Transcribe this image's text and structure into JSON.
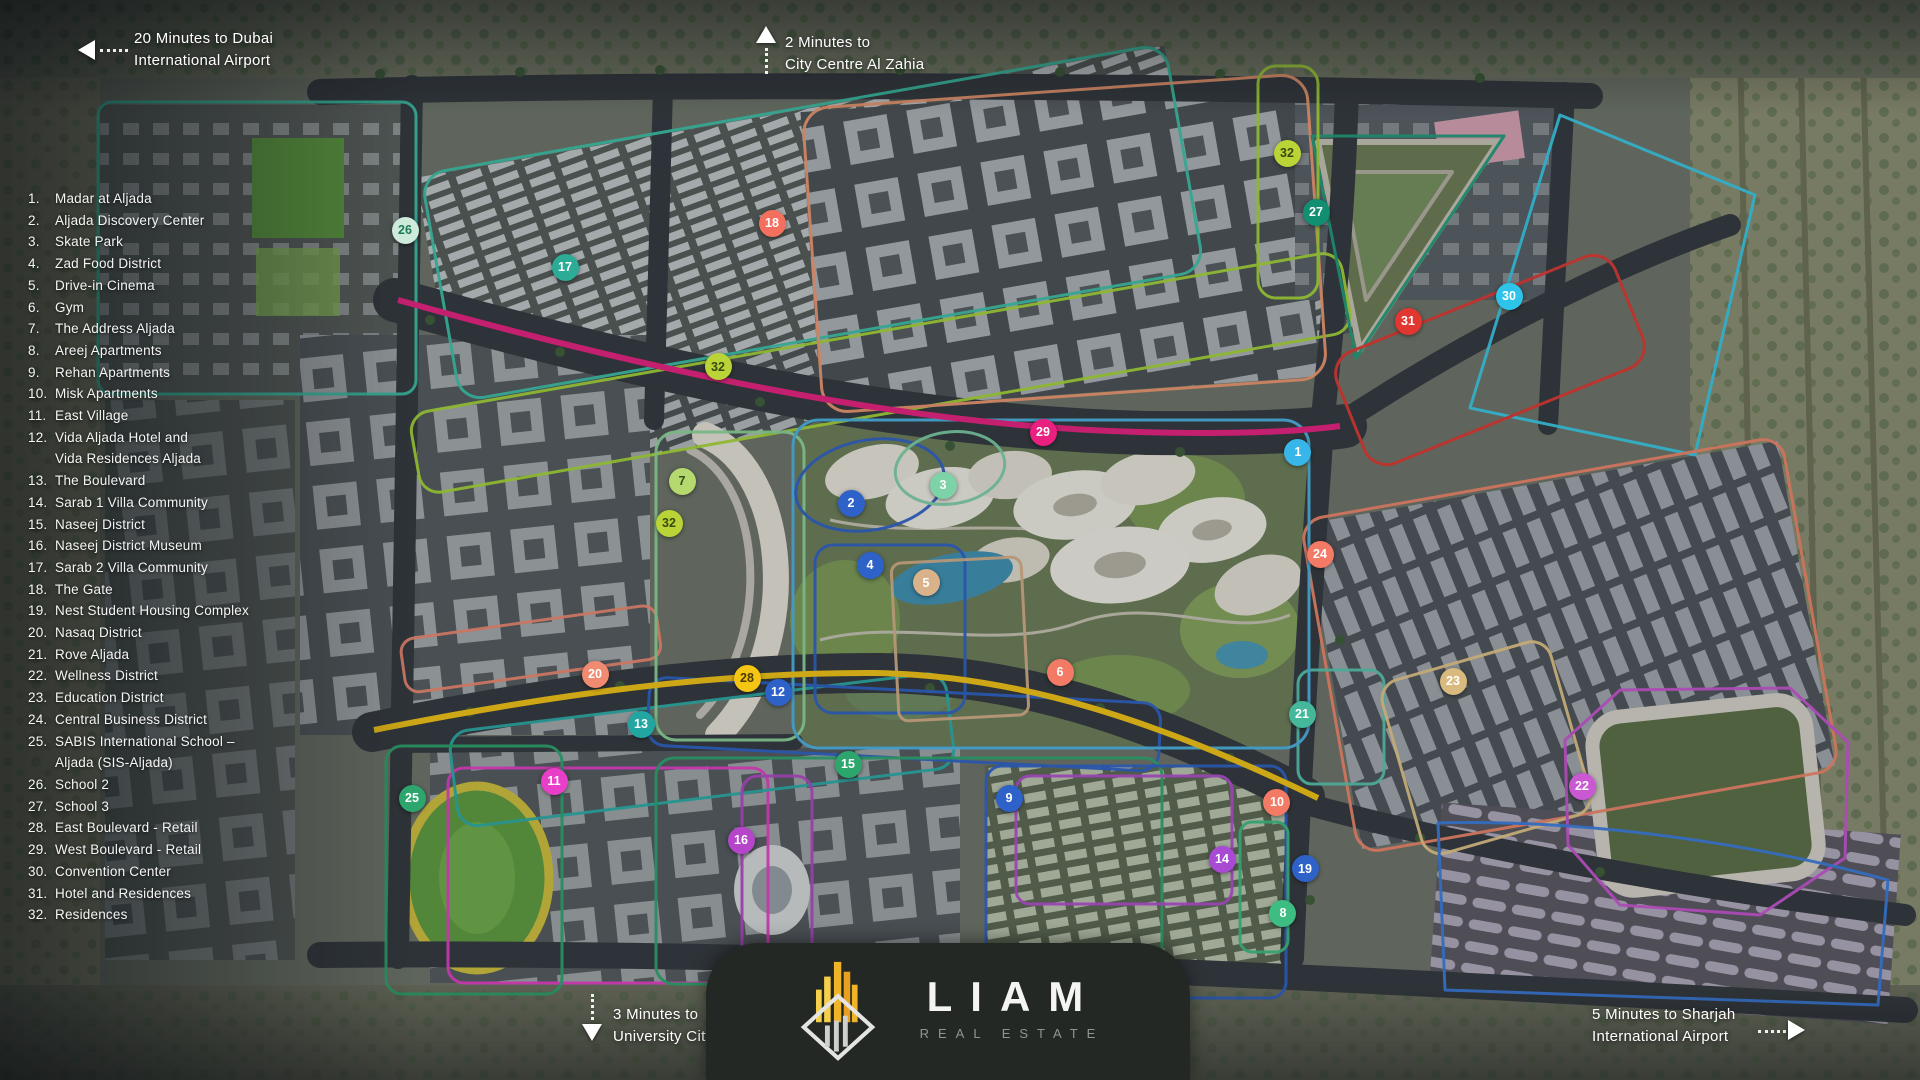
{
  "legend": {
    "items": [
      {
        "n": "1.",
        "label": "Madar at Aljada"
      },
      {
        "n": "2.",
        "label": "Aljada Discovery Center"
      },
      {
        "n": "3.",
        "label": "Skate Park"
      },
      {
        "n": "4.",
        "label": "Zad Food District"
      },
      {
        "n": "5.",
        "label": "Drive-in Cinema"
      },
      {
        "n": "6.",
        "label": "Gym"
      },
      {
        "n": "7.",
        "label": "The Address Aljada"
      },
      {
        "n": "8.",
        "label": "Areej Apartments"
      },
      {
        "n": "9.",
        "label": "Rehan Apartments"
      },
      {
        "n": "10.",
        "label": "Misk Apartments"
      },
      {
        "n": "11.",
        "label": "East Village"
      },
      {
        "n": "12.",
        "label": "Vida Aljada Hotel and\nVida Residences Aljada"
      },
      {
        "n": "13.",
        "label": "The Boulevard"
      },
      {
        "n": "14.",
        "label": "Sarab 1 Villa Community"
      },
      {
        "n": "15.",
        "label": "Naseej District"
      },
      {
        "n": "16.",
        "label": "Naseej District Museum"
      },
      {
        "n": "17.",
        "label": "Sarab 2 Villa Community"
      },
      {
        "n": "18.",
        "label": "The Gate"
      },
      {
        "n": "19.",
        "label": "Nest Student Housing Complex"
      },
      {
        "n": "20.",
        "label": "Nasaq District"
      },
      {
        "n": "21.",
        "label": "Rove Aljada"
      },
      {
        "n": "22.",
        "label": "Wellness District"
      },
      {
        "n": "23.",
        "label": "Education District"
      },
      {
        "n": "24.",
        "label": "Central Business District"
      },
      {
        "n": "25.",
        "label": "SABIS International School –\nAljada (SIS-Aljada)"
      },
      {
        "n": "26.",
        "label": "School 2"
      },
      {
        "n": "27.",
        "label": "School 3"
      },
      {
        "n": "28.",
        "label": "East Boulevard - Retail"
      },
      {
        "n": "29.",
        "label": "West Boulevard - Retail"
      },
      {
        "n": "30.",
        "label": "Convention Center"
      },
      {
        "n": "31.",
        "label": "Hotel and Residences"
      },
      {
        "n": "32.",
        "label": "Residences"
      }
    ]
  },
  "annotations": {
    "dubai": {
      "line1": "20 Minutes to Dubai",
      "line2": "International Airport",
      "arrow": "left"
    },
    "zahia": {
      "line1": "2 Minutes to",
      "line2": "City Centre Al Zahia",
      "arrow": "up"
    },
    "university": {
      "line1": "3 Minutes to",
      "line2": "University City",
      "arrow": "down"
    },
    "sharjah": {
      "line1": "5 Minutes to Sharjah",
      "line2": "International Airport",
      "arrow": "right"
    }
  },
  "logo": {
    "brand": "LIAM",
    "tagline": "REAL ESTATE"
  },
  "colors": {
    "west_boulevard_line": "#e9207f",
    "east_boulevard_line": "#f5c513",
    "park_outline": "#4db8e8",
    "card_background": "#242825"
  },
  "markers": [
    {
      "n": "1",
      "x": 1298,
      "y": 452,
      "bg": "#38b6e9"
    },
    {
      "n": "2",
      "x": 851,
      "y": 503,
      "bg": "#2e62c8"
    },
    {
      "n": "3",
      "x": 943,
      "y": 485,
      "bg": "#7ed2a8"
    },
    {
      "n": "4",
      "x": 870,
      "y": 565,
      "bg": "#2e62c8"
    },
    {
      "n": "5",
      "x": 926,
      "y": 583,
      "bg": "#d9b28a"
    },
    {
      "n": "6",
      "x": 1060,
      "y": 672,
      "bg": "#f37a65"
    },
    {
      "n": "7",
      "x": 682,
      "y": 481,
      "bg": "#b5d96e",
      "fg": "#2d5016"
    },
    {
      "n": "8",
      "x": 1283,
      "y": 913,
      "bg": "#3dbd82"
    },
    {
      "n": "9",
      "x": 1009,
      "y": 798,
      "bg": "#2e62c8"
    },
    {
      "n": "10",
      "x": 1277,
      "y": 802,
      "bg": "#f37a65"
    },
    {
      "n": "11",
      "x": 554,
      "y": 781,
      "bg": "#e83ec8"
    },
    {
      "n": "12",
      "x": 778,
      "y": 692,
      "bg": "#2e62c8"
    },
    {
      "n": "13",
      "x": 641,
      "y": 724,
      "bg": "#21a6a1"
    },
    {
      "n": "14",
      "x": 1222,
      "y": 859,
      "bg": "#a94ad4"
    },
    {
      "n": "15",
      "x": 848,
      "y": 764,
      "bg": "#2da66e"
    },
    {
      "n": "16",
      "x": 741,
      "y": 840,
      "bg": "#b546c9"
    },
    {
      "n": "17",
      "x": 565,
      "y": 267,
      "bg": "#2cab97"
    },
    {
      "n": "18",
      "x": 772,
      "y": 223,
      "bg": "#f4705e"
    },
    {
      "n": "19",
      "x": 1305,
      "y": 869,
      "bg": "#2e62c8"
    },
    {
      "n": "20",
      "x": 595,
      "y": 674,
      "bg": "#f08a70"
    },
    {
      "n": "21",
      "x": 1302,
      "y": 714,
      "bg": "#45b79b"
    },
    {
      "n": "22",
      "x": 1582,
      "y": 786,
      "bg": "#c958d2"
    },
    {
      "n": "23",
      "x": 1453,
      "y": 681,
      "bg": "#d8ba7e"
    },
    {
      "n": "24",
      "x": 1320,
      "y": 554,
      "bg": "#f37a65"
    },
    {
      "n": "25",
      "x": 412,
      "y": 798,
      "bg": "#2da66e"
    },
    {
      "n": "26",
      "x": 405,
      "y": 230,
      "bg": "#cdeadb",
      "fg": "#1c7a52"
    },
    {
      "n": "27",
      "x": 1316,
      "y": 212,
      "bg": "#128f70"
    },
    {
      "n": "28",
      "x": 747,
      "y": 678,
      "bg": "#f5c513",
      "fg": "#4a3a00"
    },
    {
      "n": "29",
      "x": 1043,
      "y": 432,
      "bg": "#e9207f"
    },
    {
      "n": "30",
      "x": 1509,
      "y": 296,
      "bg": "#2ec4ea"
    },
    {
      "n": "31",
      "x": 1408,
      "y": 321,
      "bg": "#e23731"
    },
    {
      "n": "32",
      "x": 718,
      "y": 367,
      "bg": "#bad438",
      "fg": "#39480e"
    },
    {
      "n": "32",
      "x": 669,
      "y": 523,
      "bg": "#bad438",
      "fg": "#39480e"
    },
    {
      "n": "32",
      "x": 1287,
      "y": 153,
      "bg": "#bad438",
      "fg": "#39480e"
    }
  ]
}
